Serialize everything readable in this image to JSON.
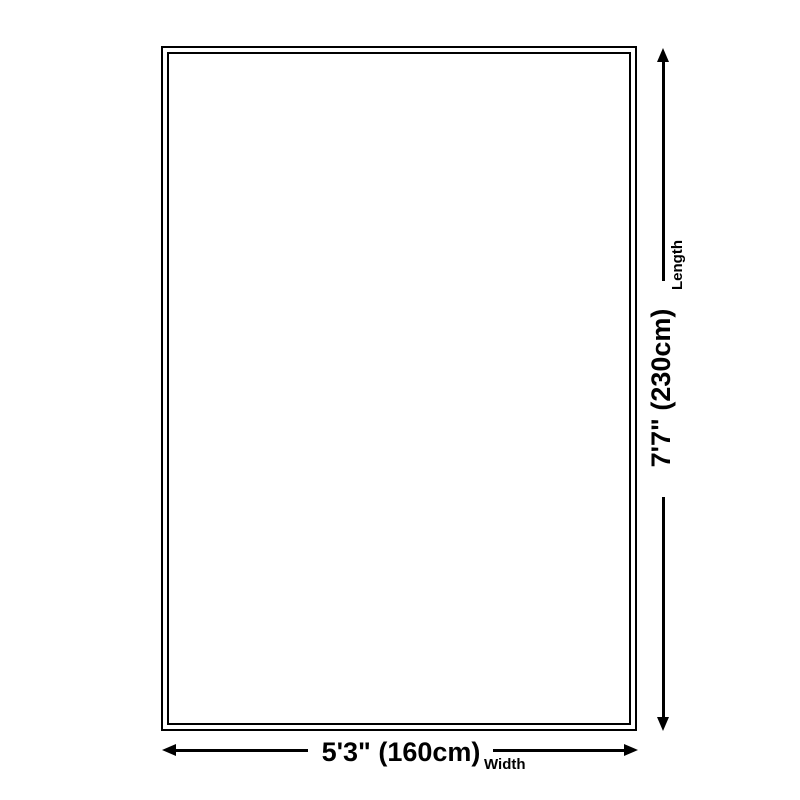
{
  "page": {
    "background_color": "#ffffff",
    "foreground_color": "#000000"
  },
  "diagram": {
    "type": "product-dimension-diagram",
    "shape": "rectangle",
    "length": {
      "value": "7'7\" (230cm)",
      "axis_label": "Length"
    },
    "width": {
      "value": "5'3\" (160cm)",
      "axis_label": "Width"
    }
  }
}
